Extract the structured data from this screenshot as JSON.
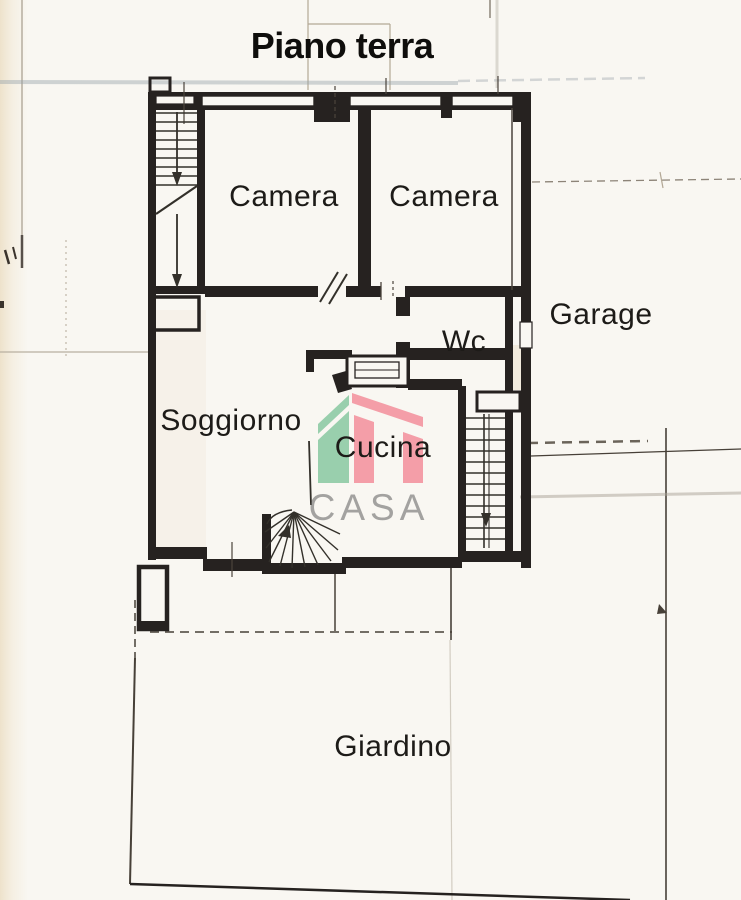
{
  "title": "Piano terra",
  "rooms": [
    {
      "id": "camera-1",
      "label": "Camera"
    },
    {
      "id": "camera-2",
      "label": "Camera"
    },
    {
      "id": "garage",
      "label": "Garage"
    },
    {
      "id": "wc",
      "label": "Wc"
    },
    {
      "id": "soggiorno",
      "label": "Soggiorno"
    },
    {
      "id": "cucina",
      "label": "Cucina"
    },
    {
      "id": "giardino",
      "label": "Giardino"
    }
  ],
  "watermark": {
    "text": "CASA",
    "green": "#8bc9a3",
    "pink": "#f2929d",
    "text_color": "#8a8a8a"
  },
  "colors": {
    "ink": "#262220",
    "pencil": "#b3a896",
    "paper": "#f9f7f2"
  }
}
